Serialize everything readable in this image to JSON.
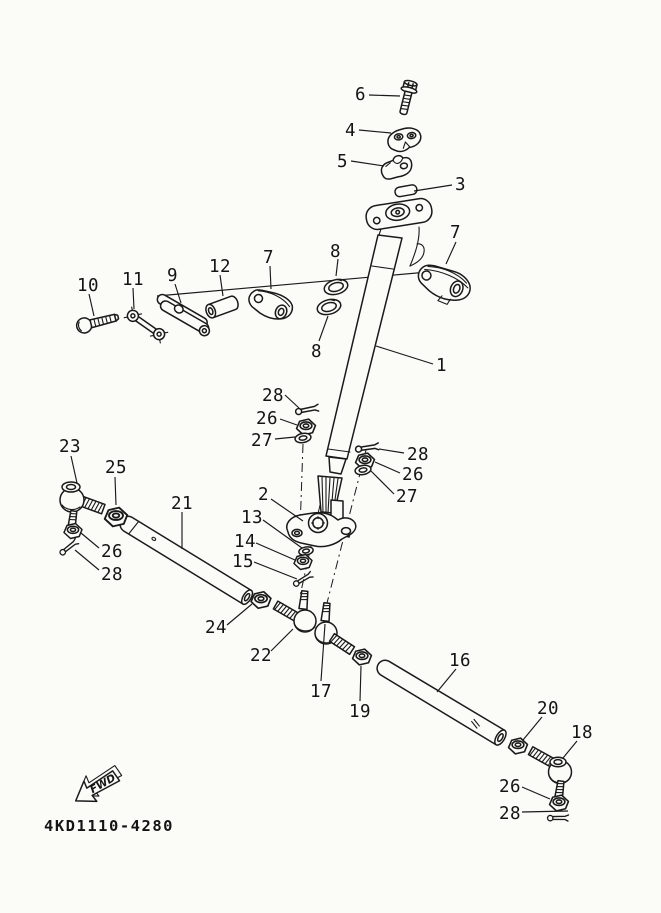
{
  "diagram": {
    "part_code": "4KD1110-4280",
    "fwd_label": "FWD",
    "colors": {
      "line": "#1a1a1a",
      "background": "#fbfbf8"
    },
    "callouts": [
      {
        "id": "bolt-6",
        "label": "6"
      },
      {
        "id": "upper-clamp-4",
        "label": "4"
      },
      {
        "id": "lower-holder-5",
        "label": "5"
      },
      {
        "id": "cap-3",
        "label": "3"
      },
      {
        "id": "bearing-holder-right-7",
        "label": "7"
      },
      {
        "id": "bearing-holder-left-7",
        "label": "7"
      },
      {
        "id": "seal-top-8",
        "label": "8"
      },
      {
        "id": "seal-bottom-8",
        "label": "8"
      },
      {
        "id": "lever-9",
        "label": "9"
      },
      {
        "id": "bolt-10",
        "label": "10"
      },
      {
        "id": "link-11",
        "label": "11"
      },
      {
        "id": "collar-12",
        "label": "12"
      },
      {
        "id": "steering-column-1",
        "label": "1"
      },
      {
        "id": "cotter-pin-28-left",
        "label": "28"
      },
      {
        "id": "nut-26-left",
        "label": "26"
      },
      {
        "id": "washer-27-left",
        "label": "27"
      },
      {
        "id": "cotter-pin-28-right",
        "label": "28"
      },
      {
        "id": "nut-26-right",
        "label": "26"
      },
      {
        "id": "washer-27-right",
        "label": "27"
      },
      {
        "id": "tie-rod-end-23",
        "label": "23"
      },
      {
        "id": "nut-25",
        "label": "25"
      },
      {
        "id": "pitman-arm-2",
        "label": "2"
      },
      {
        "id": "washer-13",
        "label": "13"
      },
      {
        "id": "nut-14",
        "label": "14"
      },
      {
        "id": "cotter-pin-15",
        "label": "15"
      },
      {
        "id": "nut-26-lower-left",
        "label": "26"
      },
      {
        "id": "cotter-pin-28-lower-left",
        "label": "28"
      },
      {
        "id": "tie-rod-21",
        "label": "21"
      },
      {
        "id": "nut-24",
        "label": "24"
      },
      {
        "id": "tie-rod-end-22",
        "label": "22"
      },
      {
        "id": "tie-rod-end-17",
        "label": "17"
      },
      {
        "id": "nut-19",
        "label": "19"
      },
      {
        "id": "tie-rod-16",
        "label": "16"
      },
      {
        "id": "nut-20",
        "label": "20"
      },
      {
        "id": "tie-rod-end-18",
        "label": "18"
      },
      {
        "id": "nut-26-bottom",
        "label": "26"
      },
      {
        "id": "cotter-pin-28-bottom",
        "label": "28"
      }
    ]
  }
}
